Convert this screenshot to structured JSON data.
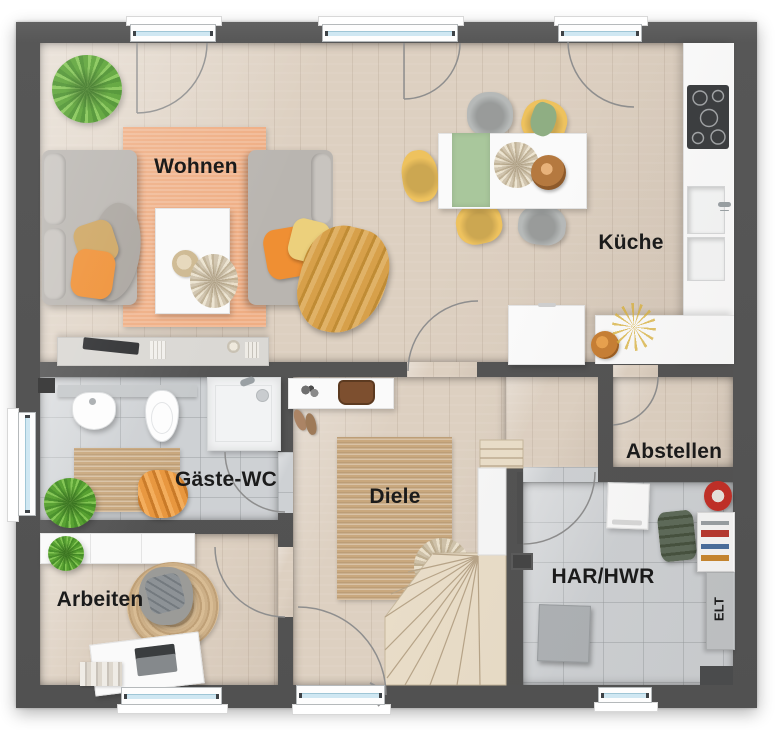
{
  "plan_type": "floor-plan",
  "rooms": {
    "wohnen": {
      "label": "Wohnen"
    },
    "kueche": {
      "label": "Küche"
    },
    "gaeste_wc": {
      "label": "Gäste-WC"
    },
    "diele": {
      "label": "Diele"
    },
    "abstellen": {
      "label": "Abstellen"
    },
    "arbeiten": {
      "label": "Arbeiten"
    },
    "har_hwr": {
      "label": "HAR/HWR"
    },
    "elt": {
      "label": "ELT"
    }
  },
  "colors": {
    "wall": "#575757",
    "floor_wood": "#ddd0c1",
    "floor_tile": "#ced1d4",
    "rug_living": "#efae84",
    "rug_jute": "#c9a87e",
    "sofa_gray": "#b9b5b0",
    "chair_gray": "#b6b9b8",
    "accent_orange": "#ef8f33",
    "accent_yellow": "#ecd07c",
    "accent_yellow2": "#eec25e",
    "accent_mustard": "#d7a04a",
    "plant_green": "#5fae2f",
    "sage_green": "#a9c79c",
    "window_glass": "#cfe7f2",
    "counter_white": "#fafafa",
    "label_text": "#1b1b1b"
  }
}
